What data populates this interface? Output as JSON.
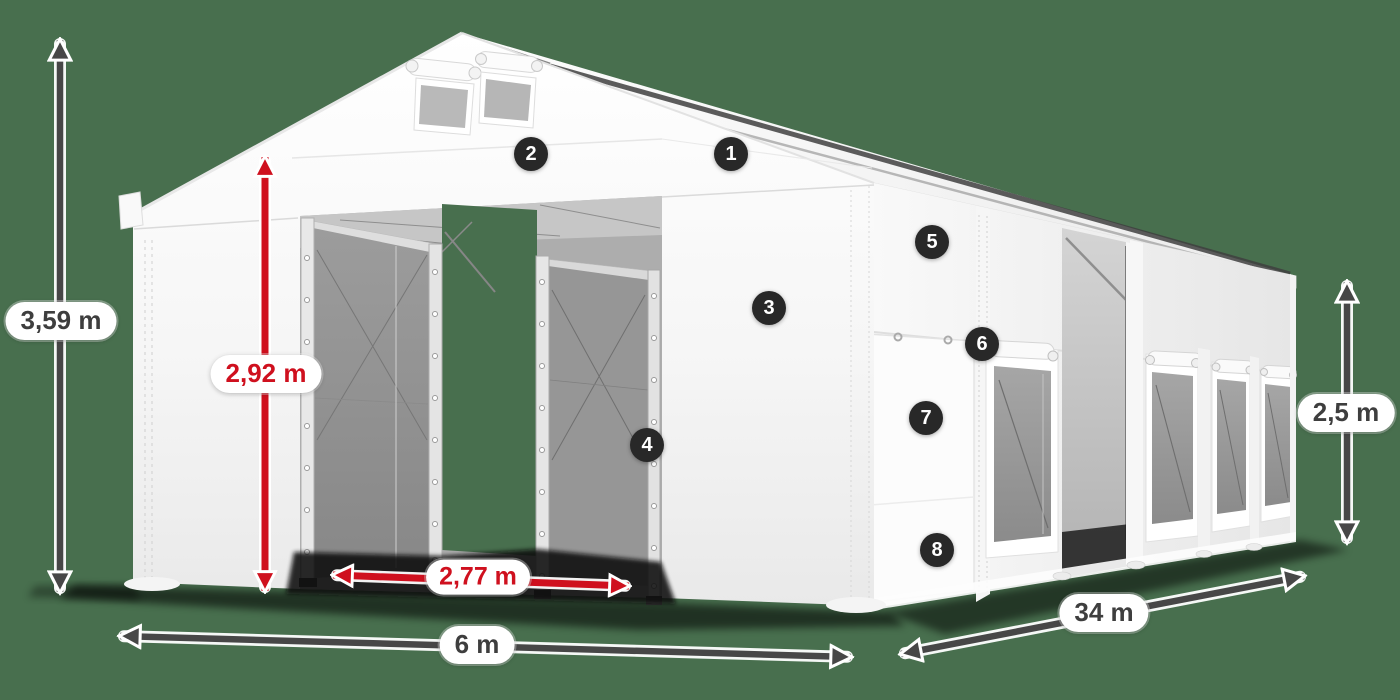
{
  "colors": {
    "background": "#486f4e",
    "accent_red": "#cf101e",
    "dimension_text": "#3e3e3e",
    "arrow_gray": "#474747",
    "badge_background": "#282828",
    "tent_white": "#f7f7f7"
  },
  "dimensions": {
    "total_height": "3,59 m",
    "entrance_height": "2,92 m",
    "entrance_width": "2,77 m",
    "front_width": "6 m",
    "side_length": "34 m",
    "side_wall_height": "2,5 m"
  },
  "hotspots": [
    "1",
    "2",
    "3",
    "4",
    "5",
    "6",
    "7",
    "8"
  ]
}
